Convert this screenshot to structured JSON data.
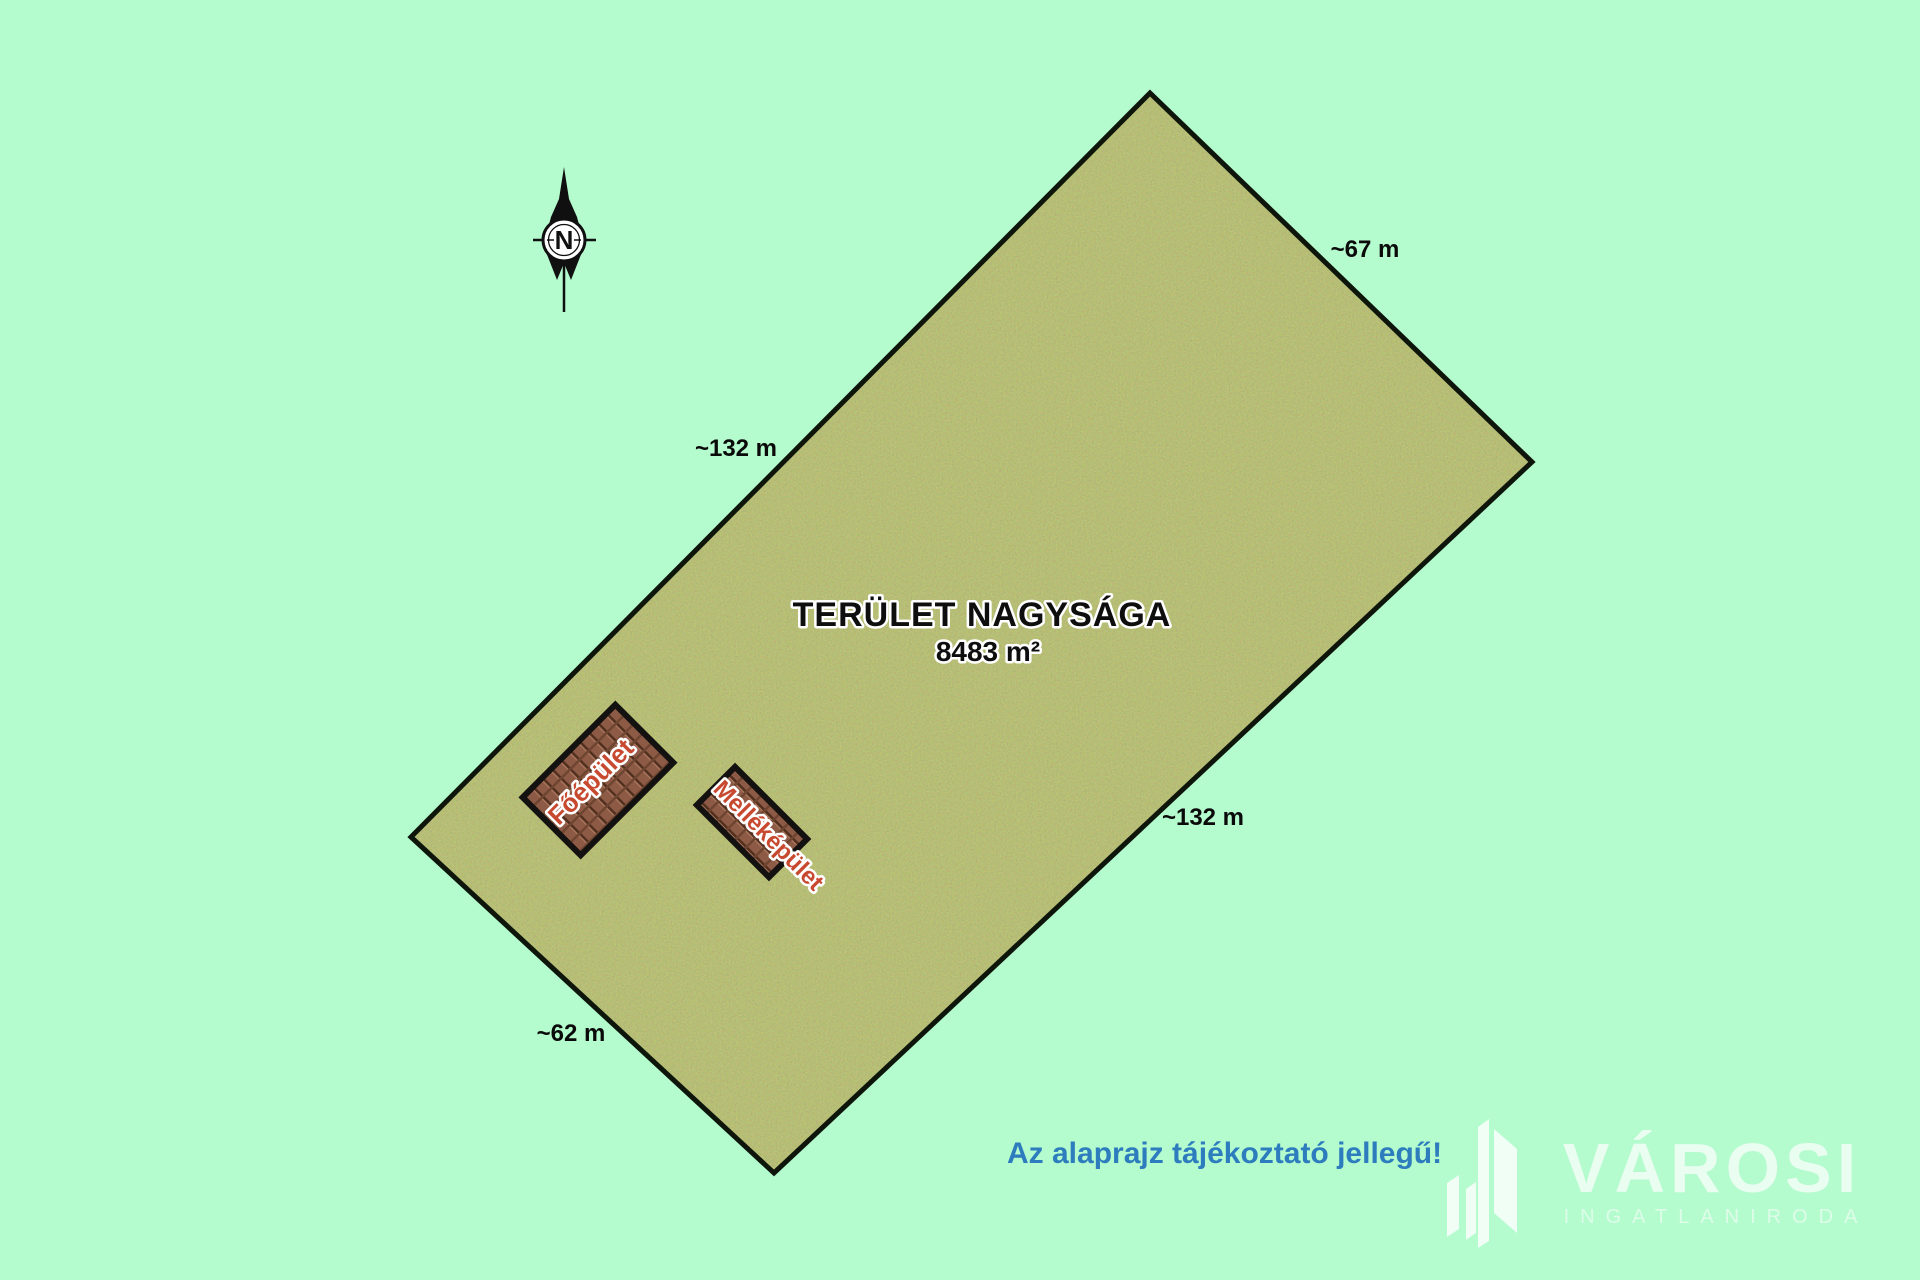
{
  "canvas": {
    "bg_color": "#b4fbce"
  },
  "compass": {
    "label": "N"
  },
  "plot": {
    "area_title": "TERÜLET NAGYSÁGA",
    "area_value": "8483 m²",
    "grass_color": "#77843c",
    "border_color": "#0e150b",
    "dimensions": {
      "north_east": "~67 m",
      "north_west": "~132 m",
      "south_east": "~132 m",
      "south_west": "~62 m"
    }
  },
  "buildings": {
    "main": {
      "label": "Főépület"
    },
    "annex": {
      "label": "Melléképület"
    },
    "label_color": "#c7492f",
    "roof_color": "#8d5a46"
  },
  "disclaimer": {
    "text": "Az alaprajz tájékoztató jellegű!",
    "color": "#2d7cbd"
  },
  "logo": {
    "brand": "VÁROSI",
    "subtitle": "INGATLANIRODA"
  }
}
